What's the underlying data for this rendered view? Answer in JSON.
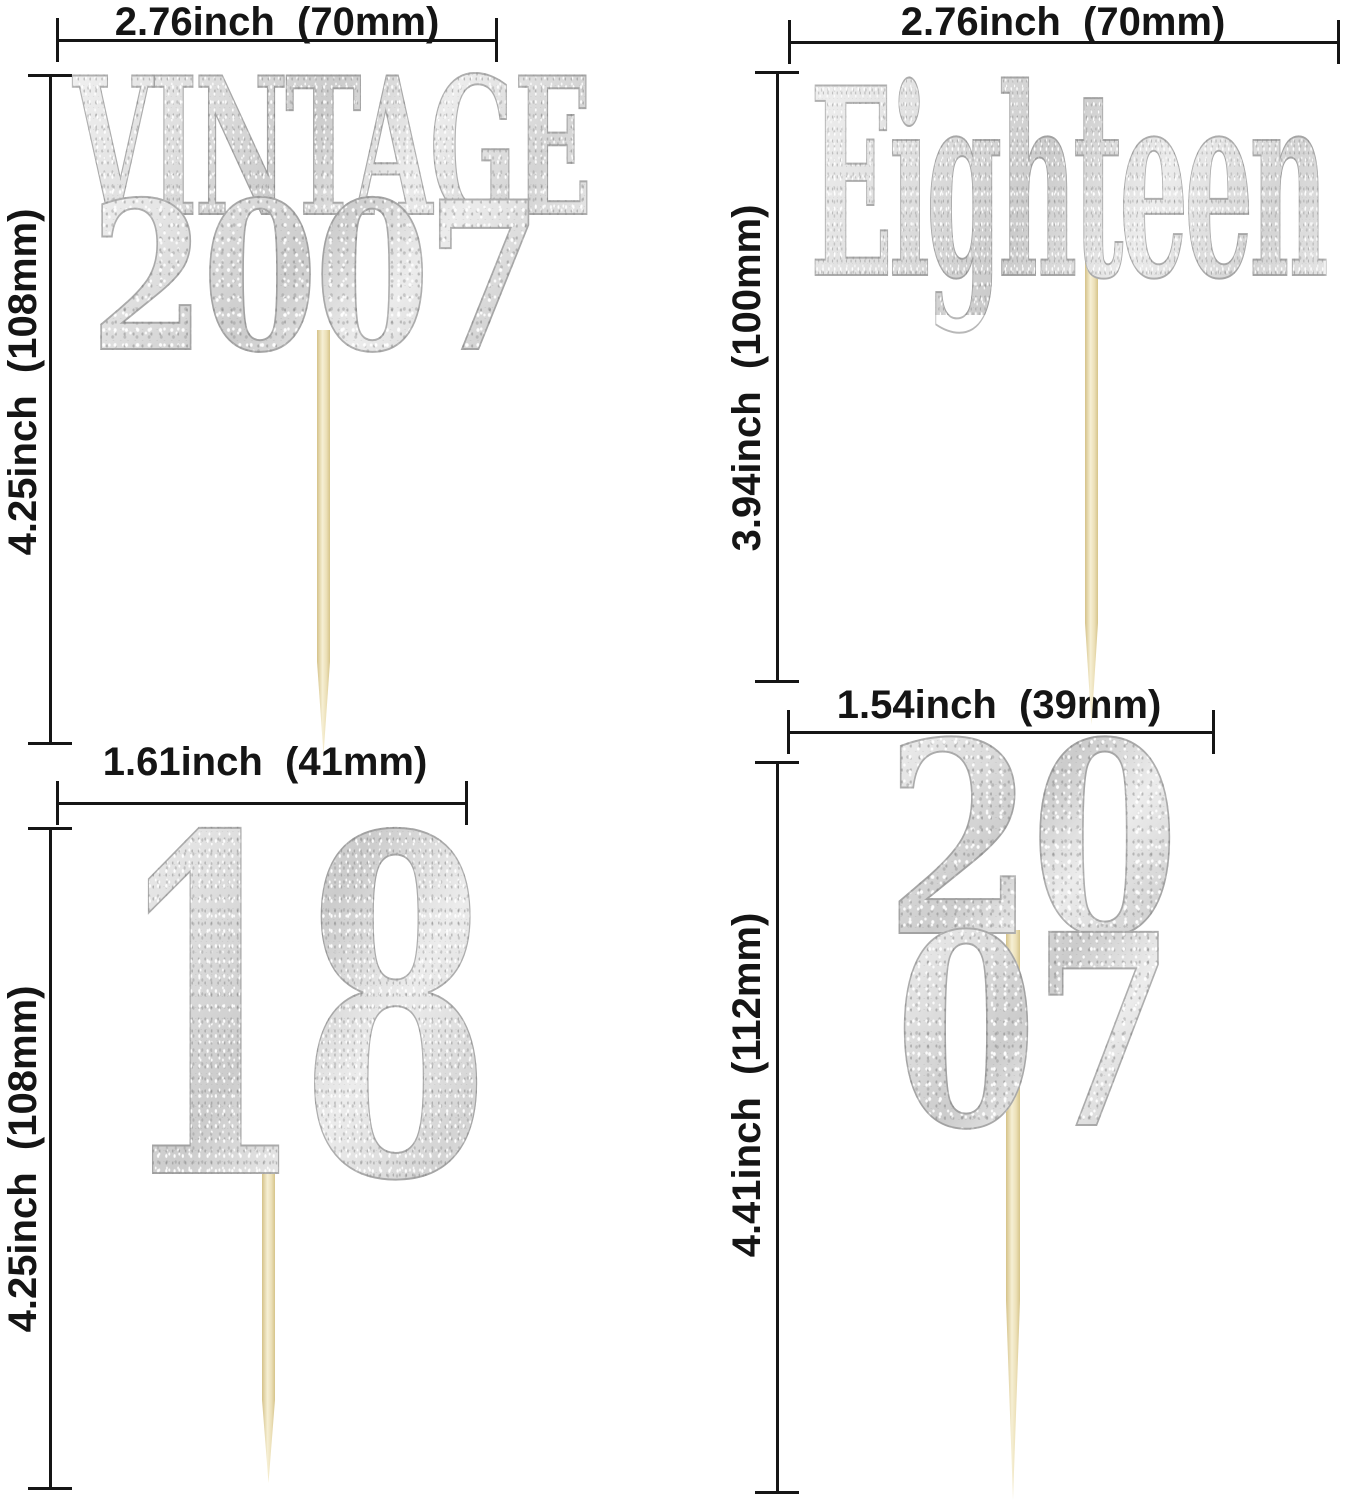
{
  "image": {
    "description": "Four silver glitter cupcake toppers on wooden toothpicks shown with size dimension lines",
    "background": "#ffffff",
    "line_color": "#151515",
    "glitter_color": "#d9d9d9",
    "stick_color": "#ece0b8"
  },
  "toppers": [
    {
      "id": "vintage-2007",
      "sign_lines": [
        "VINTAGE",
        "2007"
      ],
      "width_label": "2.76inch  (70mm)",
      "height_label": "4.25inch  (108mm)"
    },
    {
      "id": "eighteen",
      "sign_lines": [
        "Eighteen"
      ],
      "width_label": "2.76inch  (70mm)",
      "height_label": "3.94inch  (100mm)"
    },
    {
      "id": "number-18",
      "sign_lines": [
        "18"
      ],
      "width_label": "1.61inch  (41mm)",
      "height_label": "4.25inch  (108mm)"
    },
    {
      "id": "2007-stacked",
      "sign_lines": [
        "20",
        "07"
      ],
      "width_label": "1.54inch  (39mm)",
      "height_label": "4.41inch  (112mm)"
    }
  ]
}
